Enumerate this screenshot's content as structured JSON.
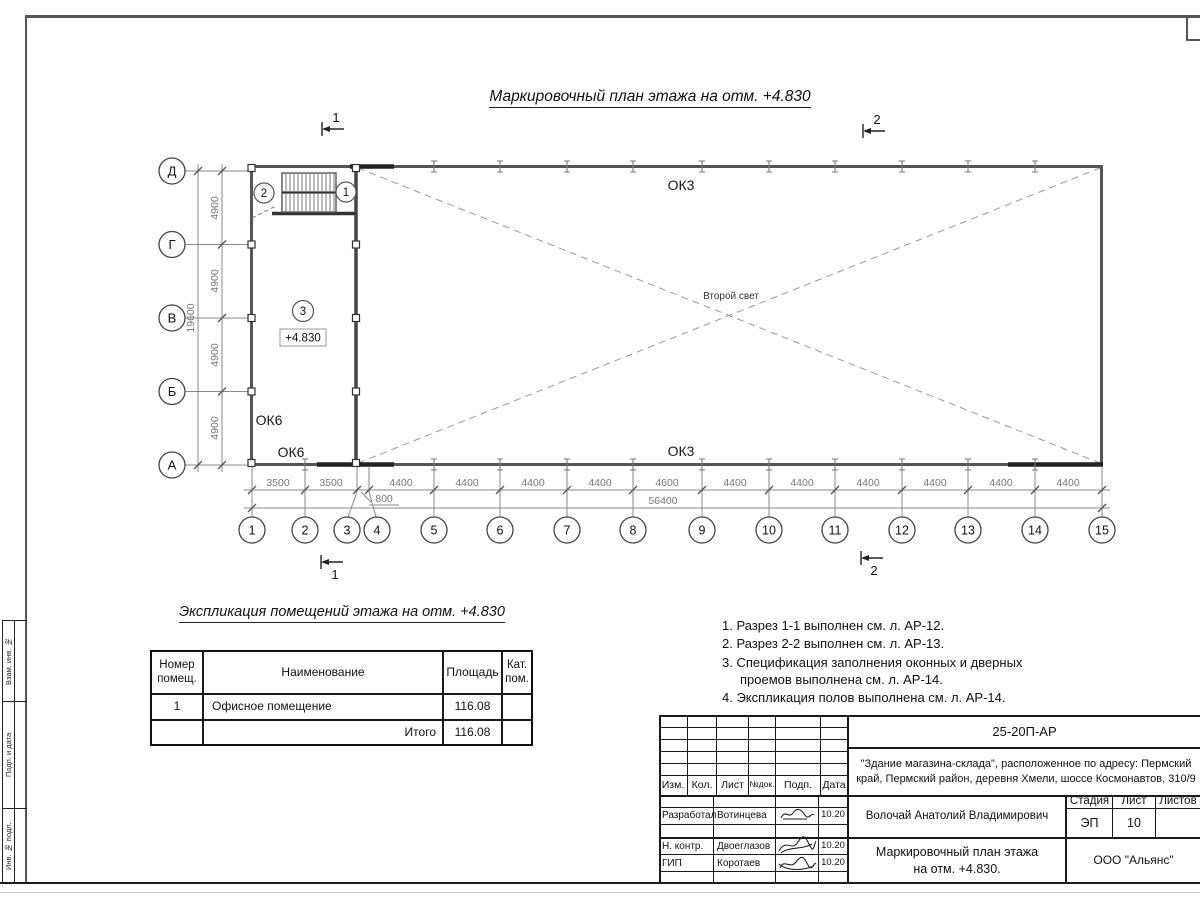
{
  "sheet": {
    "title": "Маркировочный план этажа на отм. +4.830"
  },
  "frame": {
    "side_labels": [
      "Взам. инв. №",
      "Подп. и дата",
      "Инв. № подл."
    ]
  },
  "plan": {
    "row_axes": [
      "Д",
      "Г",
      "В",
      "Б",
      "А"
    ],
    "col_axes": [
      "1",
      "2",
      "3",
      "4",
      "5",
      "6",
      "7",
      "8",
      "9",
      "10",
      "11",
      "12",
      "13",
      "14",
      "15"
    ],
    "dims_left": [
      "4900",
      "4900",
      "4900",
      "4900"
    ],
    "dim_left_total": "19600",
    "dims_bottom": [
      "3500",
      "3500",
      "4400",
      "4400",
      "4400",
      "4400",
      "4600",
      "4400",
      "4400",
      "4400",
      "4400",
      "4400",
      "4400"
    ],
    "dim_bottom_extra": "800",
    "dim_bottom_total": "56400",
    "labels": {
      "ok3_top": "ОК3",
      "ok3_bottom": "ОК3",
      "ok6_upper": "ОК6",
      "ok6_lower": "ОК6",
      "second_light": "Второй свет",
      "room_tag": "3",
      "room_elevation": "+4.830",
      "stair_tag_left": "2",
      "stair_tag_right": "1"
    },
    "sections": {
      "cut1": "1",
      "cut2": "2"
    }
  },
  "explication": {
    "title": "Экспликация помещений этажа на отм. +4.830",
    "headers": [
      "Номер помещ.",
      "Наименование",
      "Площадь",
      "Кат. пом."
    ],
    "rows": [
      [
        "1",
        "Офисное помещение",
        "116.08",
        ""
      ]
    ],
    "total_label": "Итого",
    "total_value": "116.08"
  },
  "notes": [
    "1. Разрез 1-1 выполнен см. л. АР-12.",
    "2. Разрез 2-2 выполнен см. л. АР-13.",
    "3. Спецификация заполнения оконных и дверных проемов выполнена см. л. АР-14.",
    "4. Экспликация полов выполнена см. л. АР-14."
  ],
  "titleblock": {
    "doc_code": "25-20П-АР",
    "address": "\"Здание магазина-склада\", расположенное по адресу: Пермский край, Пермский район, деревня Хмели, шоссе Космонавтов, 310/9",
    "rev_headers": [
      "Изм.",
      "Кол.",
      "Лист",
      "№док.",
      "Подп.",
      "Дата"
    ],
    "client": "Волочай Анатолий Владимирович",
    "drawing_title": "Маркировочный план этажа на отм. +4.830.",
    "stage_header": "Стадия",
    "sheet_header": "Лист",
    "sheets_header": "Листов",
    "stage": "ЭП",
    "sheet_no": "10",
    "company": "ООО \"Альянс\"",
    "roles": [
      {
        "role": "Разработал",
        "name": "Вотинцева",
        "date": "10.20"
      },
      {
        "role": "Н. контр.",
        "name": "Двоеглазов",
        "date": "10.20"
      },
      {
        "role": "ГИП",
        "name": "Коротаев",
        "date": "10.20"
      }
    ]
  }
}
